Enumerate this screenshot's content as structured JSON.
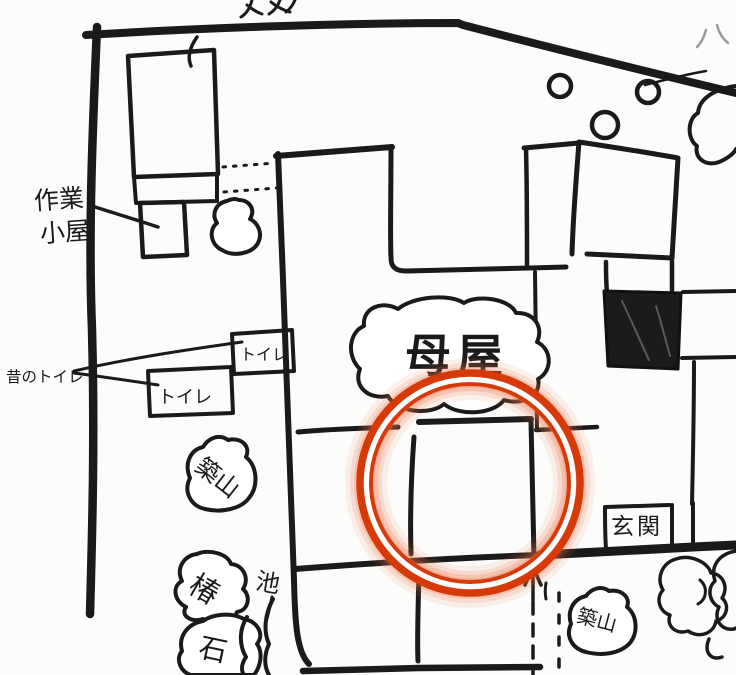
{
  "map": {
    "labels": {
      "work_shed_line1": "作業",
      "work_shed_line2": "小屋",
      "old_toilet": "昔のトイレ",
      "toilet_upper": "トイレ",
      "toilet_lower": "トイレ",
      "main_house": "母屋",
      "entrance": "玄関",
      "mound_left": "築山",
      "camellia": "椿",
      "pond": "池",
      "stone": "石",
      "mound_right": "築山"
    },
    "colors": {
      "ink": "#1a1a1a",
      "annotation_ring": "#d63a08",
      "annotation_glow": "#ef7245",
      "paper": "#fcfcfb"
    }
  }
}
